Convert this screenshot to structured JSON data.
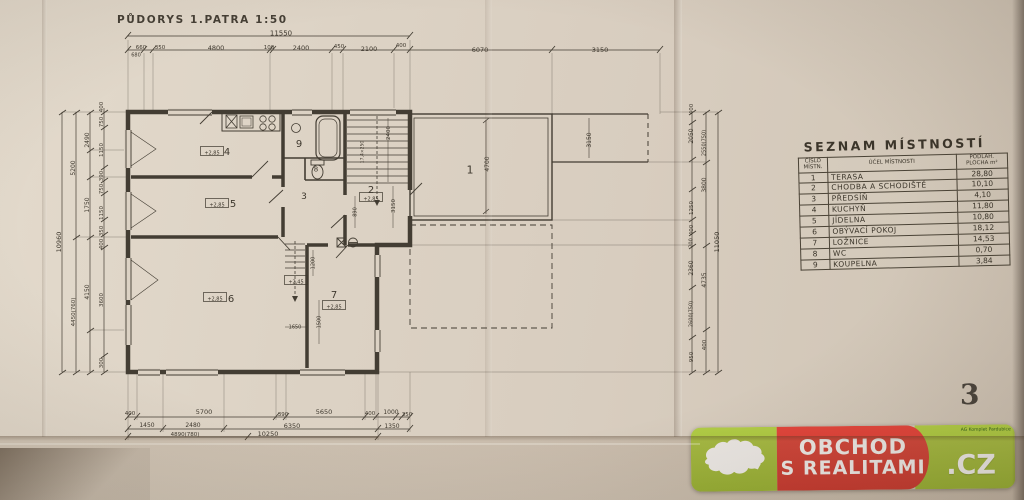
{
  "title": "PŮDORYS 1.PATRA   1:50",
  "page_number": "3",
  "room_table": {
    "title": "SEZNAM MÍSTNOSTÍ",
    "headers": {
      "num": "ČÍSLO MÍSTN.",
      "name": "ÚČEL MÍSTNOSTI",
      "area": "PODLAH. PLOCHA m²"
    },
    "rows": [
      {
        "num": "1",
        "name": "TERASA",
        "area": "28,80"
      },
      {
        "num": "2",
        "name": "CHODBA A SCHODIŠTĚ",
        "area": "10,10"
      },
      {
        "num": "3",
        "name": "PŘEDSÍŇ",
        "area": "4,10"
      },
      {
        "num": "4",
        "name": "KUCHYŇ",
        "area": "11,80"
      },
      {
        "num": "5",
        "name": "JÍDELNA",
        "area": "10,80"
      },
      {
        "num": "6",
        "name": "OBÝVACÍ POKOJ",
        "area": "18,12"
      },
      {
        "num": "7",
        "name": "LOŽNICE",
        "area": "14,53"
      },
      {
        "num": "8",
        "name": "WC",
        "area": "0,70"
      },
      {
        "num": "9",
        "name": "KOUPELNA",
        "area": "3,84"
      }
    ]
  },
  "watermark": {
    "line1": "OBCHOD",
    "line2": "S REALITAMI",
    "tld": ".CZ",
    "agency": "AG Komplet Pardubice",
    "colors": {
      "green": "#9dbb32",
      "red": "#d2352d",
      "white": "#ffffff"
    }
  },
  "plan": {
    "labels": [
      {
        "t": "11550",
        "x": 281,
        "y": 33,
        "r": 0,
        "s": 7
      },
      {
        "t": "660",
        "x": 141,
        "y": 47,
        "r": 0,
        "s": 5.5
      },
      {
        "t": "680",
        "x": 136,
        "y": 55,
        "r": 0,
        "s": 5
      },
      {
        "t": "350",
        "x": 160,
        "y": 47,
        "r": 0,
        "s": 5.5
      },
      {
        "t": "4800",
        "x": 216,
        "y": 48,
        "r": 0,
        "s": 6.5
      },
      {
        "t": "100",
        "x": 269,
        "y": 47,
        "r": 0,
        "s": 5.5
      },
      {
        "t": "2400",
        "x": 301,
        "y": 48,
        "r": 0,
        "s": 6.5
      },
      {
        "t": "450",
        "x": 339,
        "y": 46,
        "r": 0,
        "s": 5.5
      },
      {
        "t": "2100",
        "x": 369,
        "y": 49,
        "r": 0,
        "s": 6.5
      },
      {
        "t": "400",
        "x": 401,
        "y": 45,
        "r": 0,
        "s": 5.5
      },
      {
        "t": "6070",
        "x": 480,
        "y": 50,
        "r": 0,
        "s": 6.5
      },
      {
        "t": "3150",
        "x": 600,
        "y": 50,
        "r": 0,
        "s": 6.5
      },
      {
        "t": "10960",
        "x": 59,
        "y": 242,
        "r": -90,
        "s": 6.5
      },
      {
        "t": "5200",
        "x": 73,
        "y": 168,
        "r": -90,
        "s": 6
      },
      {
        "t": "4450(760)",
        "x": 73,
        "y": 312,
        "r": -90,
        "s": 5.5
      },
      {
        "t": "2490",
        "x": 87,
        "y": 140,
        "r": -90,
        "s": 6
      },
      {
        "t": "1750",
        "x": 87,
        "y": 205,
        "r": -90,
        "s": 6
      },
      {
        "t": "4150",
        "x": 87,
        "y": 292,
        "r": -90,
        "s": 6
      },
      {
        "t": "400",
        "x": 101,
        "y": 107,
        "r": -90,
        "s": 5.5
      },
      {
        "t": "750",
        "x": 101,
        "y": 122,
        "r": -90,
        "s": 5.5
      },
      {
        "t": "1150",
        "x": 101,
        "y": 150,
        "r": -90,
        "s": 5.5
      },
      {
        "t": "390",
        "x": 101,
        "y": 176,
        "r": -90,
        "s": 5.5
      },
      {
        "t": "750",
        "x": 101,
        "y": 189,
        "r": -90,
        "s": 5.5
      },
      {
        "t": "1150",
        "x": 101,
        "y": 213,
        "r": -90,
        "s": 5.5
      },
      {
        "t": "350",
        "x": 101,
        "y": 231,
        "r": -90,
        "s": 5.5
      },
      {
        "t": "400",
        "x": 101,
        "y": 244,
        "r": -90,
        "s": 5.5
      },
      {
        "t": "3600",
        "x": 101,
        "y": 300,
        "r": -90,
        "s": 5.5
      },
      {
        "t": "300",
        "x": 101,
        "y": 363,
        "r": -90,
        "s": 5.5
      },
      {
        "t": "400",
        "x": 691,
        "y": 109,
        "r": -90,
        "s": 5.5
      },
      {
        "t": "2050",
        "x": 691,
        "y": 136,
        "r": -90,
        "s": 6
      },
      {
        "t": "1250",
        "x": 691,
        "y": 208,
        "r": -90,
        "s": 5.5
      },
      {
        "t": "400",
        "x": 691,
        "y": 230,
        "r": -90,
        "s": 5.5
      },
      {
        "t": "200",
        "x": 691,
        "y": 243,
        "r": -90,
        "s": 5
      },
      {
        "t": "2360",
        "x": 691,
        "y": 268,
        "r": -90,
        "s": 6
      },
      {
        "t": "2600(750)",
        "x": 691,
        "y": 314,
        "r": -90,
        "s": 5
      },
      {
        "t": "950",
        "x": 691,
        "y": 357,
        "r": -90,
        "s": 5.5
      },
      {
        "t": "2550(750)",
        "x": 704,
        "y": 143,
        "r": -90,
        "s": 5
      },
      {
        "t": "3800",
        "x": 704,
        "y": 185,
        "r": -90,
        "s": 6
      },
      {
        "t": "4735",
        "x": 704,
        "y": 280,
        "r": -90,
        "s": 6
      },
      {
        "t": "400",
        "x": 704,
        "y": 345,
        "r": -90,
        "s": 5.5
      },
      {
        "t": "11050",
        "x": 717,
        "y": 242,
        "r": -90,
        "s": 6.5
      },
      {
        "t": "400",
        "x": 130,
        "y": 413,
        "r": 0,
        "s": 5.5
      },
      {
        "t": "5700",
        "x": 204,
        "y": 412,
        "r": 0,
        "s": 6.5
      },
      {
        "t": "390",
        "x": 283,
        "y": 414,
        "r": 0,
        "s": 5.5
      },
      {
        "t": "5650",
        "x": 324,
        "y": 412,
        "r": 0,
        "s": 6.5
      },
      {
        "t": "400",
        "x": 370,
        "y": 413,
        "r": 0,
        "s": 5.5
      },
      {
        "t": "1000",
        "x": 391,
        "y": 412,
        "r": 0,
        "s": 6
      },
      {
        "t": "350",
        "x": 407,
        "y": 414,
        "r": 0,
        "s": 5.5
      },
      {
        "t": "1450",
        "x": 147,
        "y": 425,
        "r": 0,
        "s": 6
      },
      {
        "t": "2480",
        "x": 193,
        "y": 425,
        "r": 0,
        "s": 6
      },
      {
        "t": "6350",
        "x": 292,
        "y": 426,
        "r": 0,
        "s": 6.5
      },
      {
        "t": "1350",
        "x": 392,
        "y": 426,
        "r": 0,
        "s": 6
      },
      {
        "t": "4890(780)",
        "x": 185,
        "y": 434,
        "r": 0,
        "s": 5.5
      },
      {
        "t": "10250",
        "x": 268,
        "y": 434,
        "r": 0,
        "s": 6.5
      },
      {
        "t": "1",
        "x": 470,
        "y": 170,
        "r": 0,
        "s": 11,
        "n": "room-number-terasa"
      },
      {
        "t": "2",
        "x": 371,
        "y": 190,
        "r": 0,
        "s": 10,
        "n": "room-number-chodba"
      },
      {
        "t": "3",
        "x": 304,
        "y": 196,
        "r": 0,
        "s": 9,
        "n": "room-number-predsin"
      },
      {
        "t": "4",
        "x": 227,
        "y": 152,
        "r": 0,
        "s": 10,
        "n": "room-number-kuchyn"
      },
      {
        "t": "5",
        "x": 233,
        "y": 204,
        "r": 0,
        "s": 10,
        "n": "room-number-jidelna"
      },
      {
        "t": "6",
        "x": 231,
        "y": 299,
        "r": 0,
        "s": 10,
        "n": "room-number-obyvaci-pokoj"
      },
      {
        "t": "7",
        "x": 334,
        "y": 295,
        "r": 0,
        "s": 10,
        "n": "room-number-loznice"
      },
      {
        "t": "8",
        "x": 316,
        "y": 169,
        "r": 0,
        "s": 7,
        "n": "room-number-wc"
      },
      {
        "t": "9",
        "x": 299,
        "y": 144,
        "r": 0,
        "s": 10,
        "n": "room-number-koupelna"
      },
      {
        "t": "+2,85",
        "x": 212,
        "y": 153,
        "r": 0,
        "s": 5,
        "b": true,
        "n": "level-label"
      },
      {
        "t": "+2,85",
        "x": 217,
        "y": 205,
        "r": 0,
        "s": 5,
        "b": true,
        "n": "level-label"
      },
      {
        "t": "+2,85",
        "x": 215,
        "y": 299,
        "r": 0,
        "s": 5,
        "b": true,
        "n": "level-label"
      },
      {
        "t": "+2,85",
        "x": 334,
        "y": 307,
        "r": 0,
        "s": 5,
        "b": true,
        "n": "level-label"
      },
      {
        "t": "+2,85",
        "x": 371,
        "y": 199,
        "r": 0,
        "s": 5,
        "b": true,
        "n": "level-label"
      },
      {
        "t": "+2,45",
        "x": 296,
        "y": 282,
        "r": 0,
        "s": 5,
        "b": true,
        "n": "level-label"
      },
      {
        "t": "4700",
        "x": 487,
        "y": 164,
        "r": -90,
        "s": 6
      },
      {
        "t": "3150",
        "x": 589,
        "y": 140,
        "r": -90,
        "s": 6
      },
      {
        "t": "2400",
        "x": 388,
        "y": 133,
        "r": -90,
        "s": 5.5
      },
      {
        "t": "3150",
        "x": 393,
        "y": 206,
        "r": -90,
        "s": 5.5
      },
      {
        "t": "890",
        "x": 355,
        "y": 212,
        "r": -90,
        "s": 5
      },
      {
        "t": "17,4×250",
        "x": 362,
        "y": 152,
        "r": -90,
        "s": 4.5
      },
      {
        "t": "1200",
        "x": 313,
        "y": 263,
        "r": -90,
        "s": 5
      },
      {
        "t": "1500",
        "x": 319,
        "y": 322,
        "r": -90,
        "s": 5
      },
      {
        "t": "1650",
        "x": 295,
        "y": 327,
        "r": 0,
        "s": 5
      }
    ]
  }
}
